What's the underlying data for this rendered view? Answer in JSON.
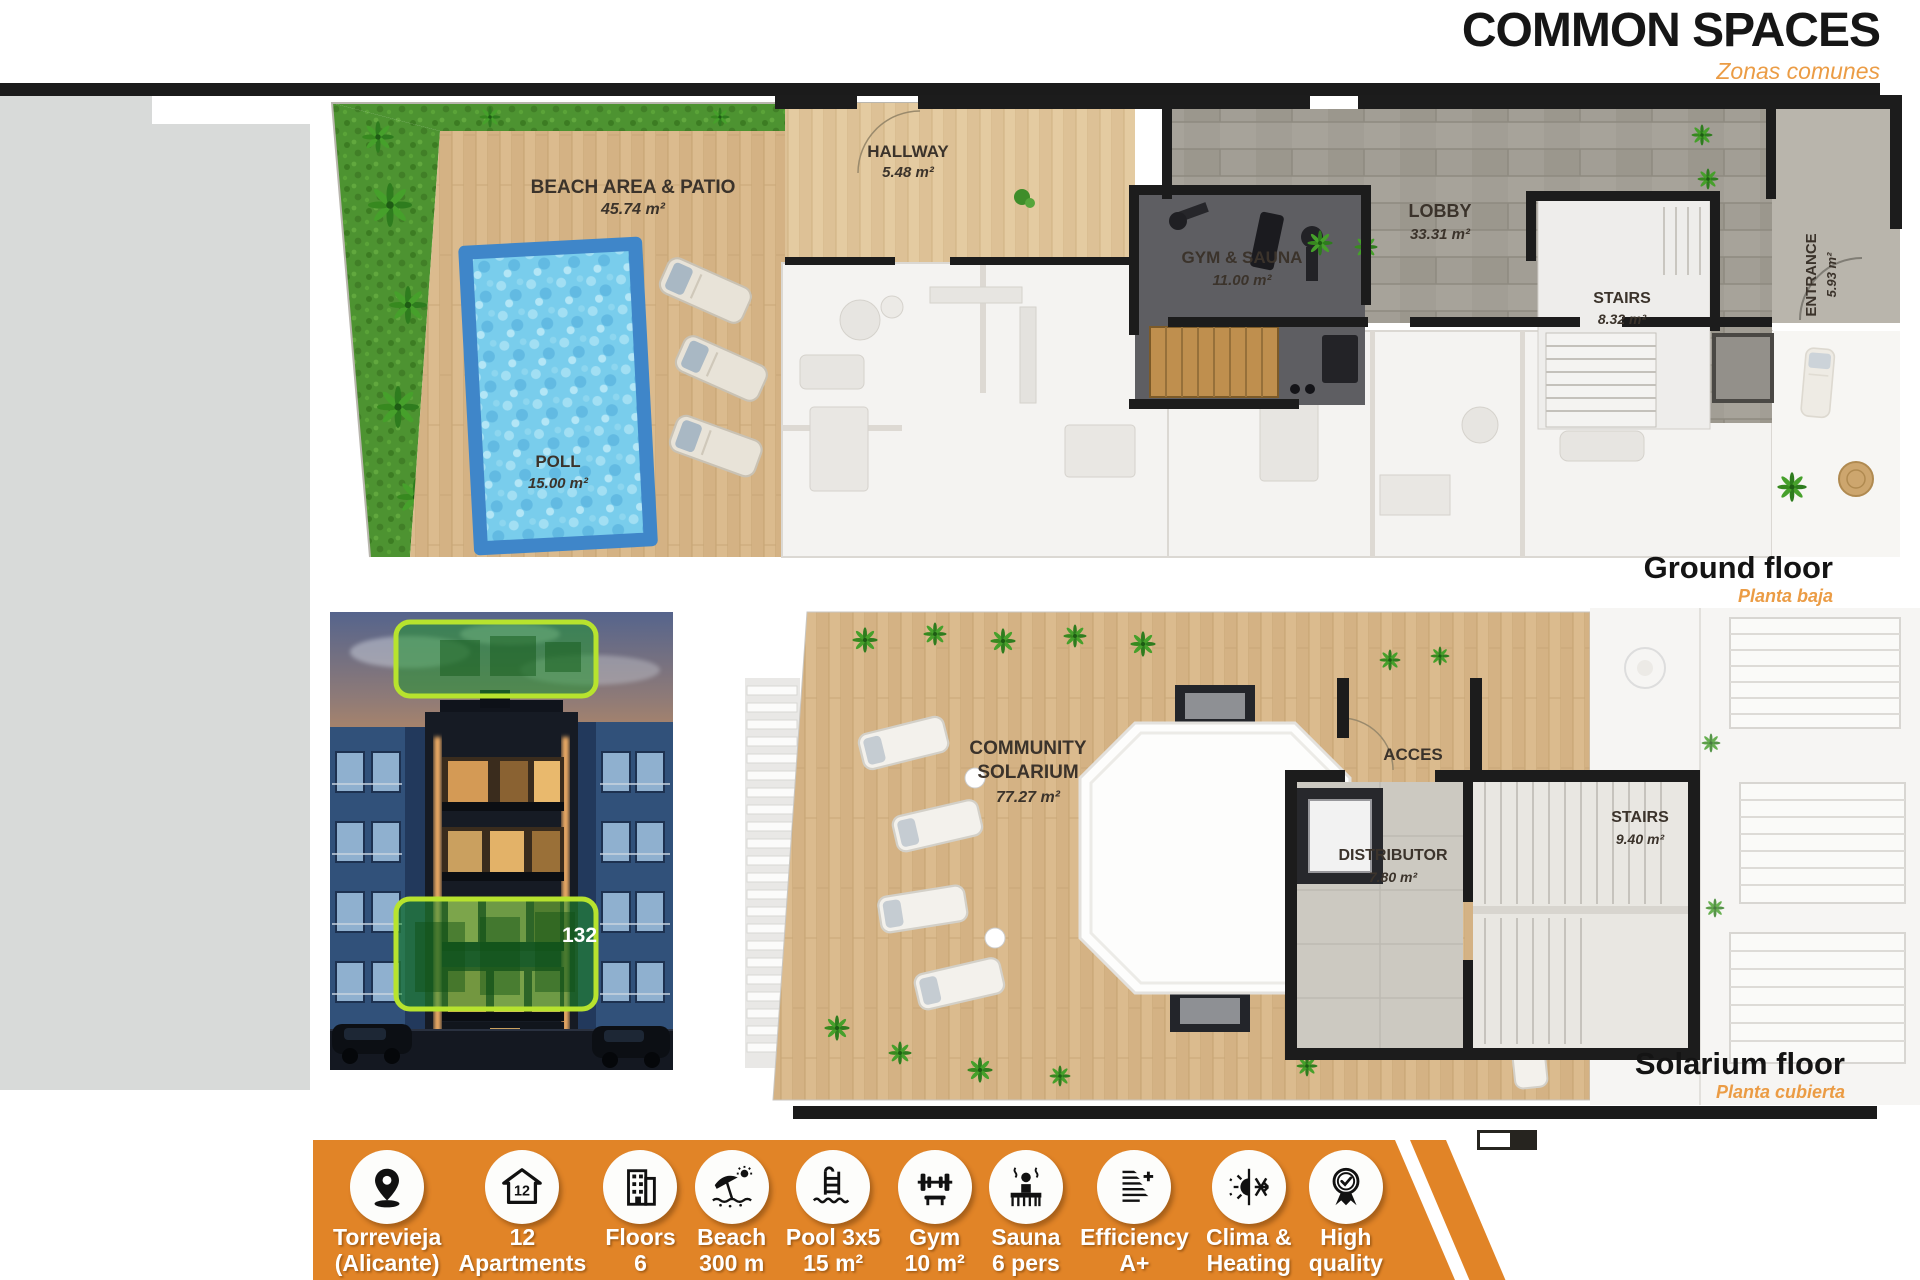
{
  "page": {
    "title": "COMMON SPACES",
    "subtitle": "Zonas comunes"
  },
  "ground_floor": {
    "caption": "Ground floor",
    "caption_sub": "Planta baja",
    "rooms": {
      "beach": {
        "name": "BEACH AREA & PATIO",
        "area": "45.74 m²"
      },
      "pool": {
        "name": "POLL",
        "area": "15.00 m²"
      },
      "hallway": {
        "name": "HALLWAY",
        "area": "5.48 m²"
      },
      "gym": {
        "name": "GYM & SAUNA",
        "area": "11.00 m²"
      },
      "lobby": {
        "name": "LOBBY",
        "area": "33.31 m²"
      },
      "stairs": {
        "name": "STAIRS",
        "area": "8.32 m²"
      },
      "entrance": {
        "name": "ENTRANCE",
        "area": "5.93 m²"
      }
    }
  },
  "solarium_floor": {
    "caption": "Solarium floor",
    "caption_sub": "Planta cubierta",
    "rooms": {
      "community": {
        "name_line1": "COMMUNITY",
        "name_line2": "SOLARIUM",
        "area": "77.27 m²"
      },
      "acces": {
        "name": "ACCES"
      },
      "distributor": {
        "name": "DISTRIBUTOR",
        "area": "7.80 m²"
      },
      "stairs": {
        "name": "STAIRS",
        "area": "9.40 m²"
      }
    }
  },
  "building_photo": {
    "highlight_label": "132"
  },
  "features": {
    "items": [
      {
        "icon": "location-pin-icon",
        "line1": "Torrevieja",
        "line2": "(Alicante)"
      },
      {
        "icon": "apartments-icon",
        "line1": "12",
        "line2": "Apartments"
      },
      {
        "icon": "floors-icon",
        "line1": "Floors",
        "line2": "6"
      },
      {
        "icon": "beach-icon",
        "line1": "Beach",
        "line2": "300 m"
      },
      {
        "icon": "pool-icon",
        "line1": "Pool 3x5",
        "line2": "15 m²"
      },
      {
        "icon": "gym-icon",
        "line1": "Gym",
        "line2": "10 m²"
      },
      {
        "icon": "sauna-icon",
        "line1": "Sauna",
        "line2": "6 pers"
      },
      {
        "icon": "efficiency-icon",
        "line1": "Efficiency",
        "line2": "A+"
      },
      {
        "icon": "clima-icon",
        "line1": "Clima &",
        "line2": "Heating"
      },
      {
        "icon": "quality-icon",
        "line1": "High",
        "line2": "quality"
      }
    ]
  },
  "colors": {
    "accent_orange": "#e18427",
    "subtitle_orange": "#eb9c45",
    "bar_black": "#1b1b1b",
    "highlight_green": "#b7e32e",
    "pool_blue": "#3f86c9"
  }
}
